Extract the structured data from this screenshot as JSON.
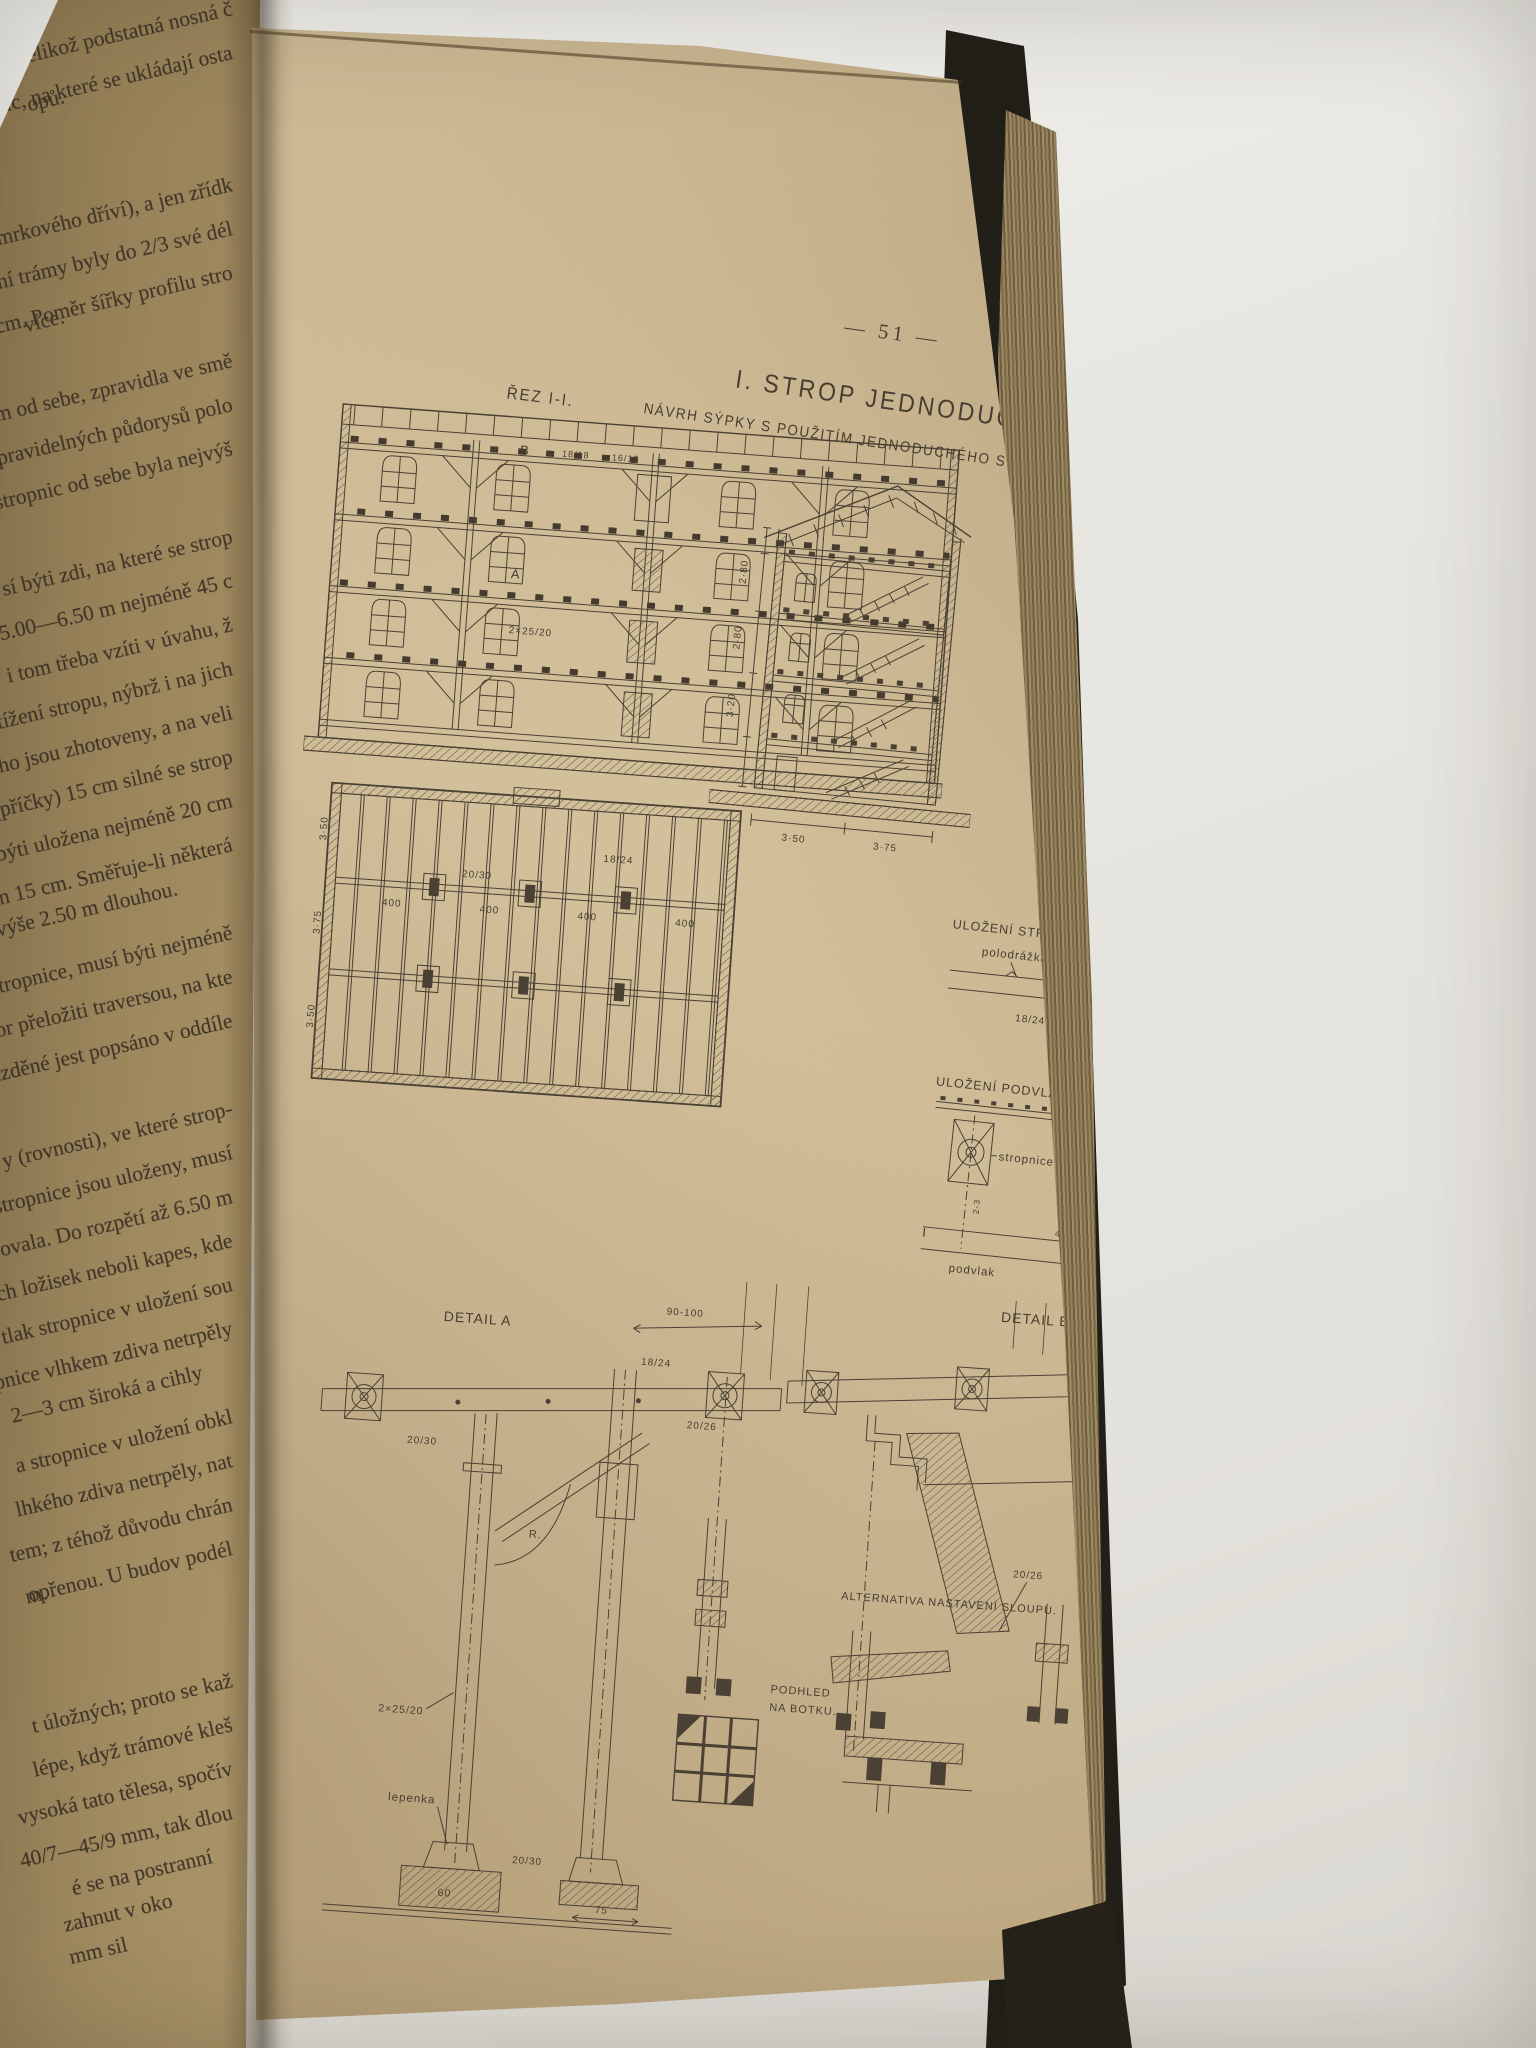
{
  "book": {
    "left_page": {
      "text_lines": [
        "ové, jelikož podstatná nosná č",
        "ic, na které se ukládají osta",
        "opů.",
        "",
        "smrkového dříví), a jen zřídk",
        "ní trámy byly do 2/3 své dél",
        "8 cm. Poměr šířky profilu stro",
        "více.",
        "m od sebe, zpravidla ve smě",
        "nepravidelných půdorysů polo",
        "stropnic od sebe byla nejvýš",
        "",
        "sí býti zdi, na které se strop",
        "e 5.00—6.50 m nejméně 45 c",
        "i tom třeba vzíti v úvahu, ž",
        "tížení stropu, nýbrž i na jich",
        "ého jsou zhotoveny, a na veli",
        "(příčky) 15 cm silné se strop",
        "á býti uložena nejméně 20 cm",
        "jen 15 cm. Směřuje-li některá",
        "výše 2.50 m dlouhou.",
        "stropnice, musí býti nejméně",
        "or přeložiti traversou, na kte",
        "ázděné jest popsáno v oddíle",
        "",
        "y (rovnosti), ve které strop-",
        "stropnice jsou uloženy, musí",
        "ovala. Do rozpětí až 6.50 m",
        "ch ložisek neboli kapes, kde",
        "tlak stropnice v uložení sou",
        "pnice vlhkem zdiva netrpěly",
        "2—3 cm široká a cihly",
        "a stropnice v uložení obkl",
        "lhkého zdiva netrpěly, nat",
        "tem; z téhož důvodu chrán",
        "opřenou. U budov podél",
        "m.",
        "",
        "t úložných; proto se kaž",
        "lépe, když trámové kleš",
        "vysoká tato tělesa, spočív",
        "40/7—45/9 mm, tak dlou",
        "é se na postranní",
        "zahnut v oko",
        "mm sil"
      ]
    },
    "right_page": {
      "page_number": "— 51 —",
      "heading": {
        "title": "I. STROP JEDNODUCHÝ.",
        "subtitle": "NÁVRH SÝPKY S POUŽITÍM JEDNODUCHÉHO STROPU."
      },
      "section_i": {
        "label": "ŘEZ I-I.",
        "marker_b": "B",
        "marker_a": "A",
        "dim_roof": "18/18",
        "dim_right": "16/15",
        "dim_beam": "2×25/20"
      },
      "section_ii": {
        "label": "ŘEZ II-II.",
        "dim_v1": "2·80",
        "dim_v2": "2·80",
        "dim_v3": "3·20",
        "dim_h1": "3·50",
        "dim_h2": "3·75"
      },
      "plan": {
        "dim_left_top": "3·50",
        "dim_left_mid": "3·75",
        "dim_left_bot": "3·50",
        "dim_bay": "400",
        "dim_joist": "18/24",
        "dim_beam": "20/30"
      },
      "stropnice_detail": {
        "title": "ULOŽENÍ STROPNICE DO ZDI.",
        "polodrazka": "polodrážka",
        "drazka": "drážka",
        "dim_beam": "18/24",
        "dim_gap": "4-5",
        "dim_pocket": "20"
      },
      "podvlak_detail": {
        "title": "ULOŽENÍ PODVLAKU DO ZDI",
        "stropnice": "stropnice",
        "podvlak": "podvlak",
        "dim_beam": "18/24",
        "dim_gap": "2-3",
        "dim_strap": "40/7 · 45/9",
        "dim_pocket": "10 - 15 - 20",
        "marker": "I"
      },
      "detail_a": {
        "label": "DETAIL A",
        "dim_span": "90-100",
        "dim_beam": "20/30",
        "dim_joist": "18/24",
        "dim_brace": "20/26",
        "radius": "R.",
        "dim_column": "2×25/20",
        "lepenka": "lepenka",
        "dim_width": "60",
        "dim_offset": "75",
        "dim_base": "20/30"
      },
      "detail_b": {
        "label": "DETAIL B."
      },
      "alternativa": {
        "label": "ALTERNATIVA NASTAVENÍ SLOUPU.",
        "dim": "20/26"
      },
      "podhled": {
        "label_1": "PODHLED",
        "label_2": "NA BOTKU."
      }
    }
  }
}
